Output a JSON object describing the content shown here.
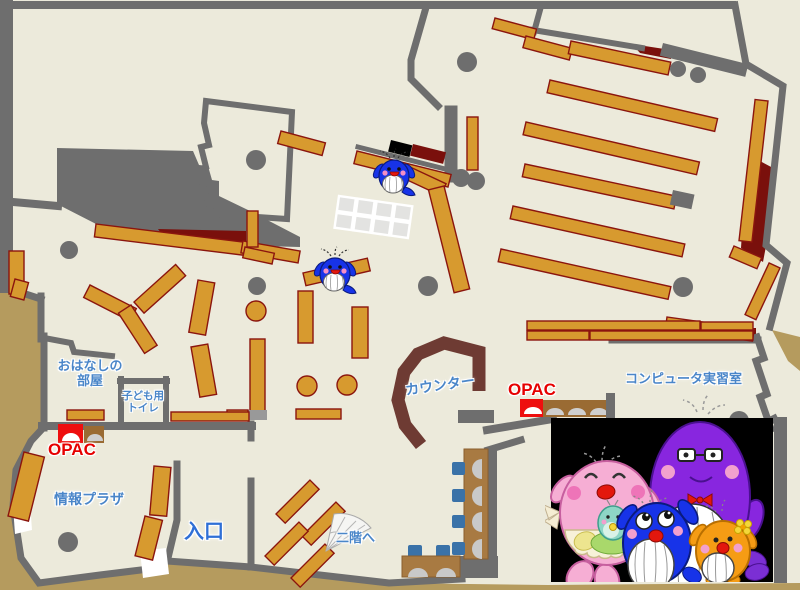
{
  "map_title": "library-floor-map-1f",
  "labels": {
    "storytelling_room": "おはなしの\n部屋",
    "kids_toilet": "子ども用\nトイレ",
    "opac_left": "OPAC",
    "info_plaza": "情報プラザ",
    "entrance": "入口",
    "counter": "カウンター",
    "opac_right": "OPAC",
    "computer_room": "コンピュータ実習室",
    "to_second_floor": "二階へ"
  },
  "colors": {
    "outside_tan": "#b59b5e",
    "floor_cream": "#eceadb",
    "wall_gray": "#6e6e6e",
    "shelf_orange": "#d79a2f",
    "shelf_border": "#8b150e",
    "dark_red_area": "#7a100c",
    "counter_brown": "#6e3b33",
    "desk_brown": "#a87a42",
    "chair_blue": "#3a72a8",
    "label_blue": "#4a86c9",
    "entrance_blue": "#2f6fd6",
    "opac_red": "#e60000",
    "photo_background": "#000000",
    "whale_blue": "#1733e8",
    "mascot_pink": "#f6aed4",
    "mascot_purple": "#8826df",
    "mascot_orange": "#f59c14",
    "mascot_baby_teal": "#8ed6c6"
  },
  "icons": [
    "whale-mascot-icon",
    "opac-terminal-icon",
    "stairs-fan-icon",
    "pillar-icon",
    "round-table-icon",
    "bookshelf-icon",
    "mascot-family-photo"
  ]
}
